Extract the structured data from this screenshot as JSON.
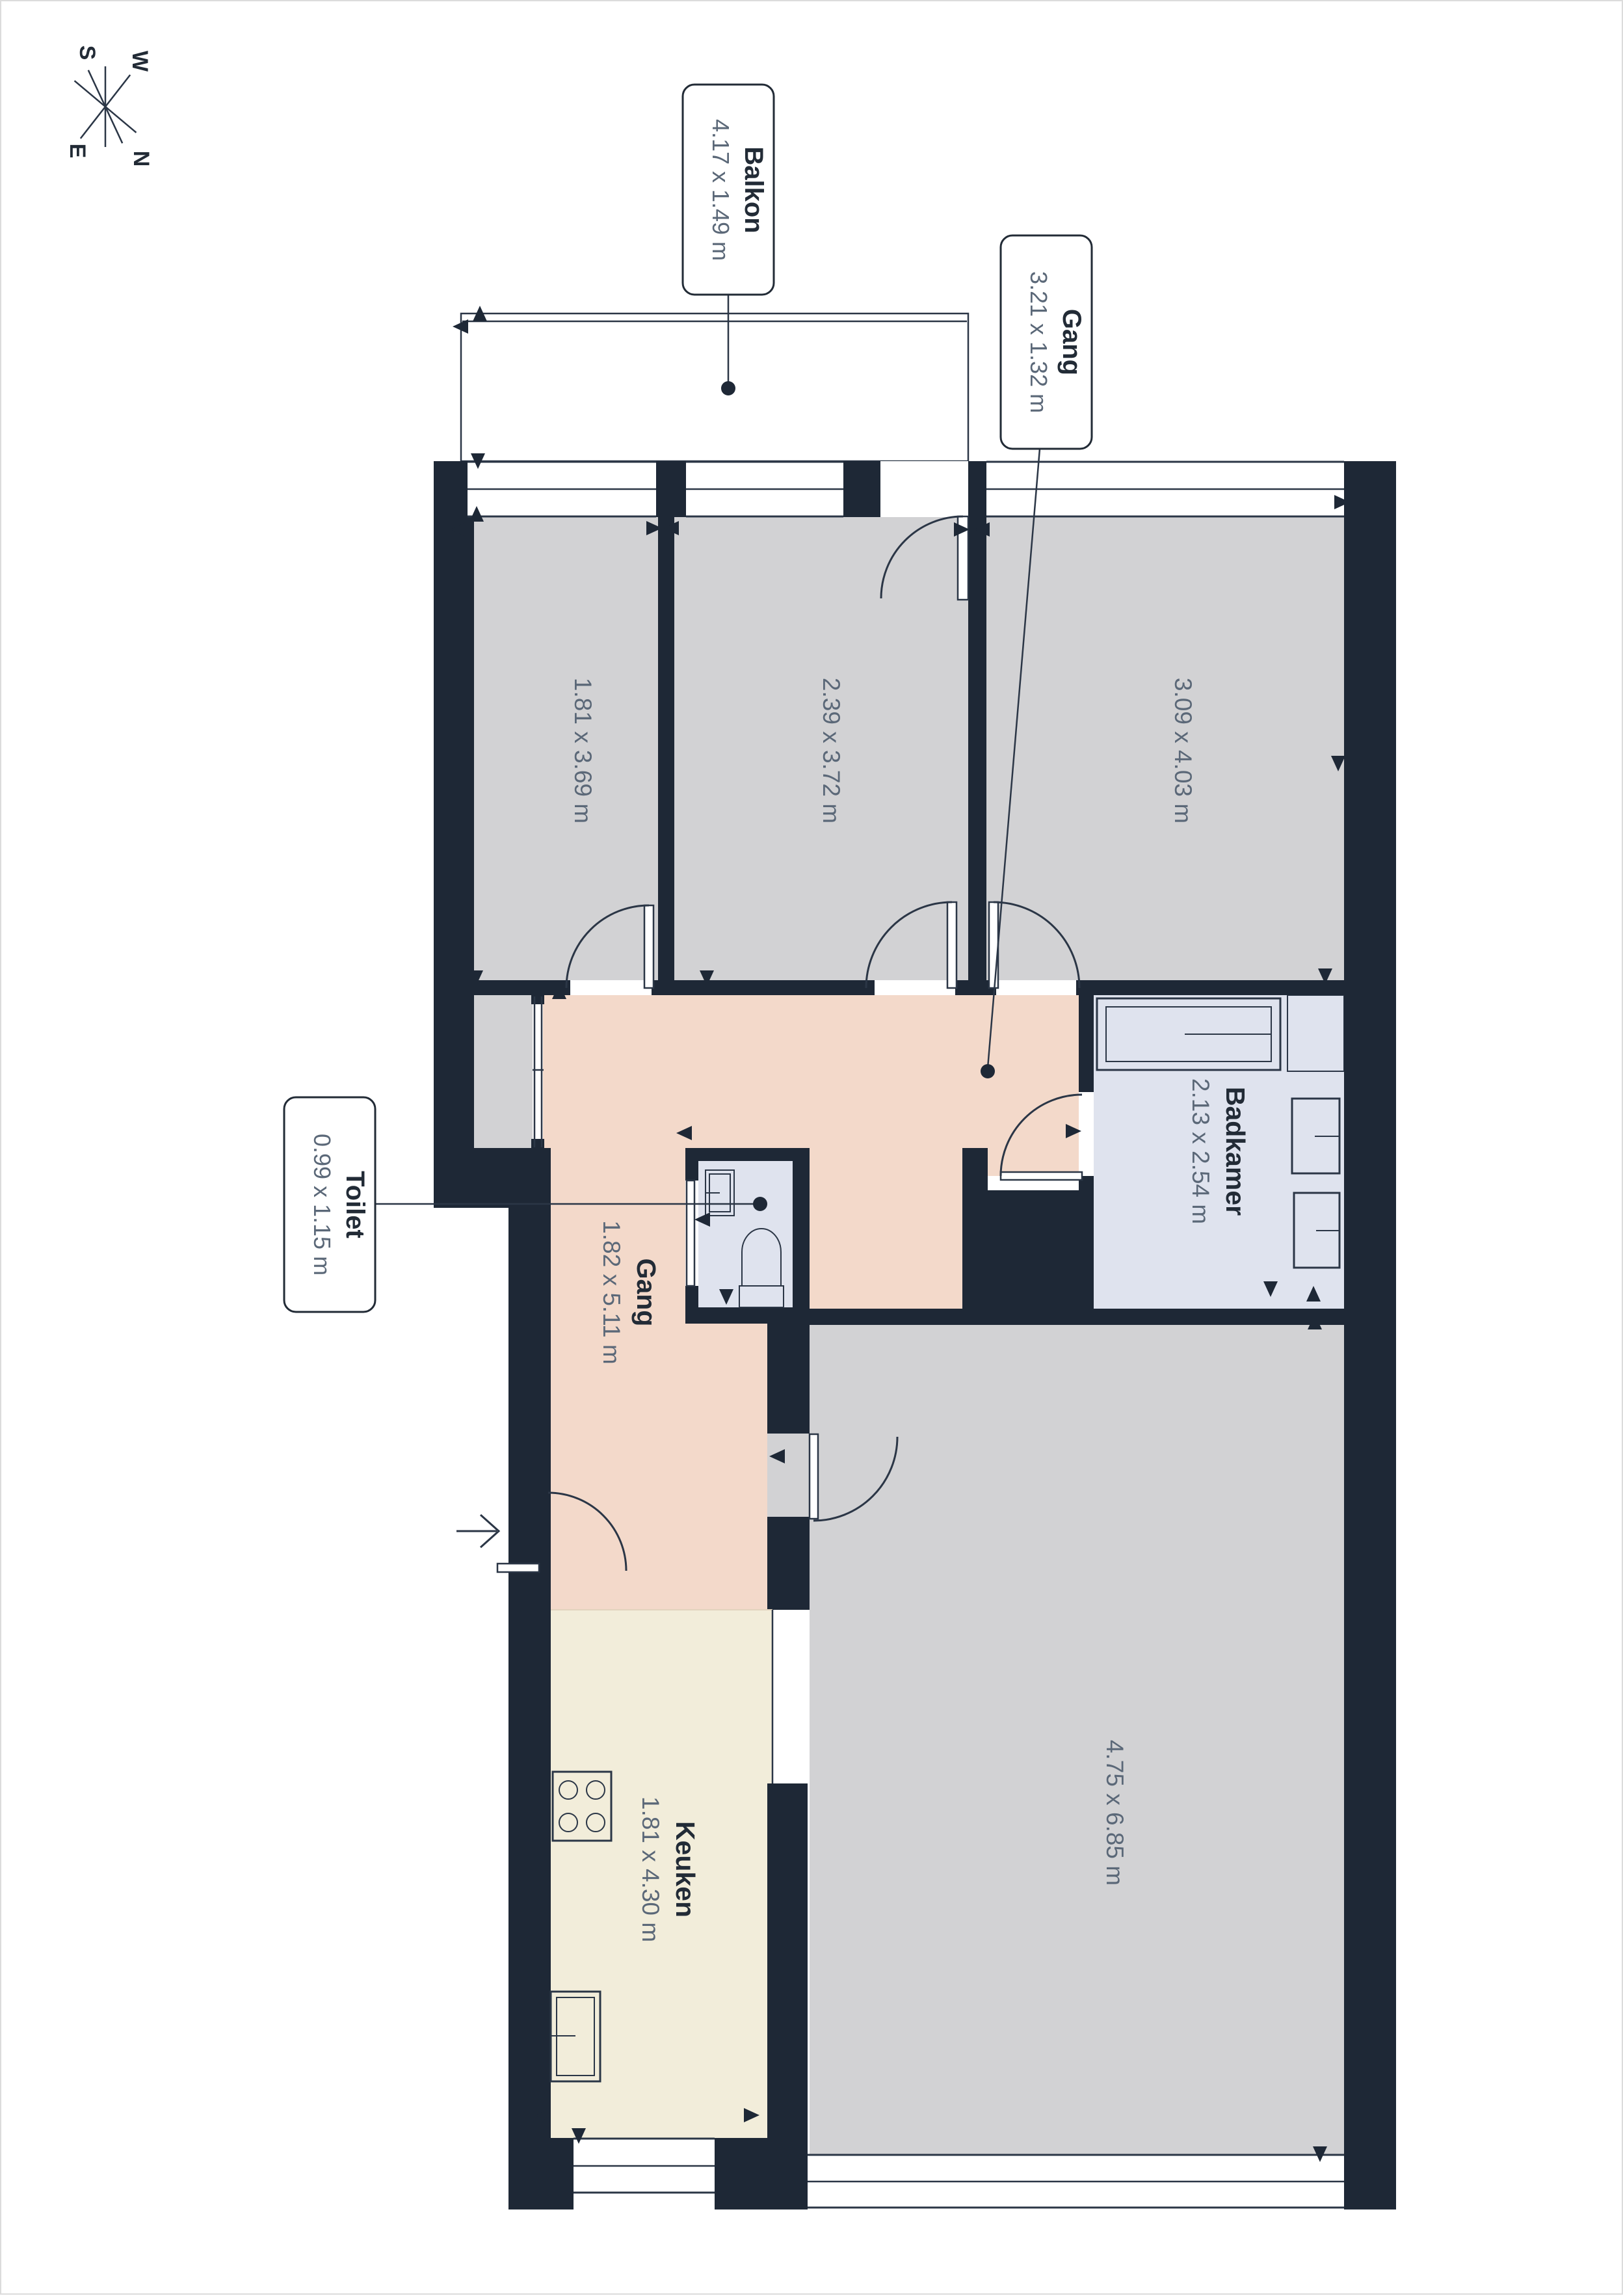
{
  "plan_title": "",
  "compass": {
    "north": "N",
    "east": "E",
    "south": "S",
    "west": "W"
  },
  "callouts": {
    "balkon": {
      "name": "Balkon",
      "dims": "4.17 x 1.49 m"
    },
    "gang_top": {
      "name": "Gang",
      "dims": "3.21 x 1.32 m"
    },
    "toilet": {
      "name": "Toilet",
      "dims": "0.99 x 1.15 m"
    }
  },
  "rooms": {
    "room1": {
      "name": "",
      "dims": "1.81 x 3.69 m"
    },
    "room2": {
      "name": "",
      "dims": "2.39 x 3.72 m"
    },
    "room3": {
      "name": "",
      "dims": "3.09 x 4.03 m"
    },
    "gang": {
      "name": "Gang",
      "dims": "1.82 x 5.11 m"
    },
    "badkamer": {
      "name": "Badkamer",
      "dims": "2.13 x 2.54 m"
    },
    "keuken": {
      "name": "Keuken",
      "dims": "1.81 x 4.30 m"
    },
    "living": {
      "name": "",
      "dims": "4.75 x 6.85 m"
    }
  },
  "colors": {
    "wall": "#1e2836",
    "thin_line": "#2b3646",
    "floor_gray": "#d2d2d4",
    "floor_pink": "#f3d9ca",
    "floor_blue": "#dfe3ee",
    "floor_cream": "#f2edda",
    "floor_balcony": "#ececed",
    "dim_text": "#5b6878",
    "title_text": "#222b36"
  }
}
